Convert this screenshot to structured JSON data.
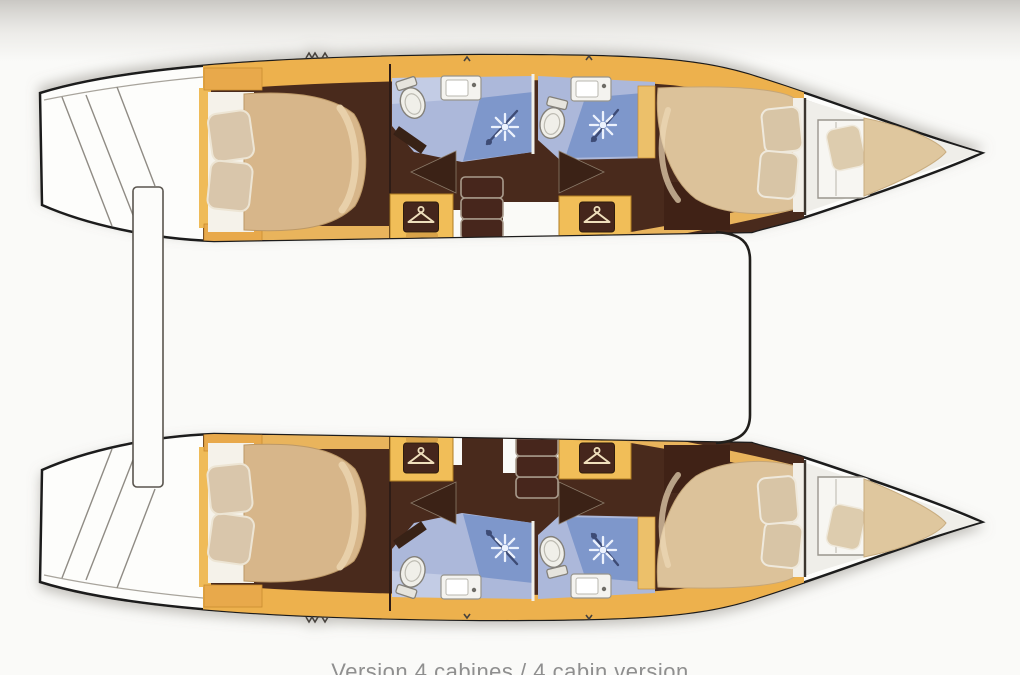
{
  "caption": "Version 4 cabines / 4 cabin version",
  "diagram": {
    "type": "boat-deck-plan",
    "vessel": "catamaran, top view, bows to the right",
    "layout_name": "4 cabin version",
    "hull_count": 2,
    "per_hull_features": [
      "aft double berth cabin with two pillows",
      "aft head with toilet, washbasin and shower",
      "companionway steps with two hanging lockers",
      "forward head with toilet, washbasin and shower",
      "forward double berth cabin with two pillows",
      "forepeak single berth"
    ],
    "between_hulls": [
      "aft davit bar",
      "forward crossbeam line"
    ]
  },
  "icons": {
    "hanger_icon": "clothes hanger in dark locker box (4x)",
    "shower_sprayer_icon": "white starburst spray (4x)",
    "toilet_icon": "white bowl with tank (4x)",
    "sink_icon": "white basin with faucet dot (4x)",
    "companionway_steps": "three stacked treads (2x)",
    "deck_hatch_marks": "small zigzag marks on deck"
  },
  "colors": {
    "background": "#FAFAF8",
    "hull_fill": "#FDFDFB",
    "hull_outline": "#1C1C1C",
    "band_yellow": "#EDB14E",
    "cabinetry_yellow": "#F1BE58",
    "floor_brown": "#4A2A1D",
    "bed_tan": "#DCC29A",
    "pillow_tan": "#D9C6AB",
    "bath_floor_blue": "#ACB8DA",
    "shower_blue": "#7E97CB",
    "fixture_white": "#F2F1EA",
    "caption_gray": "#8F8F8F"
  }
}
